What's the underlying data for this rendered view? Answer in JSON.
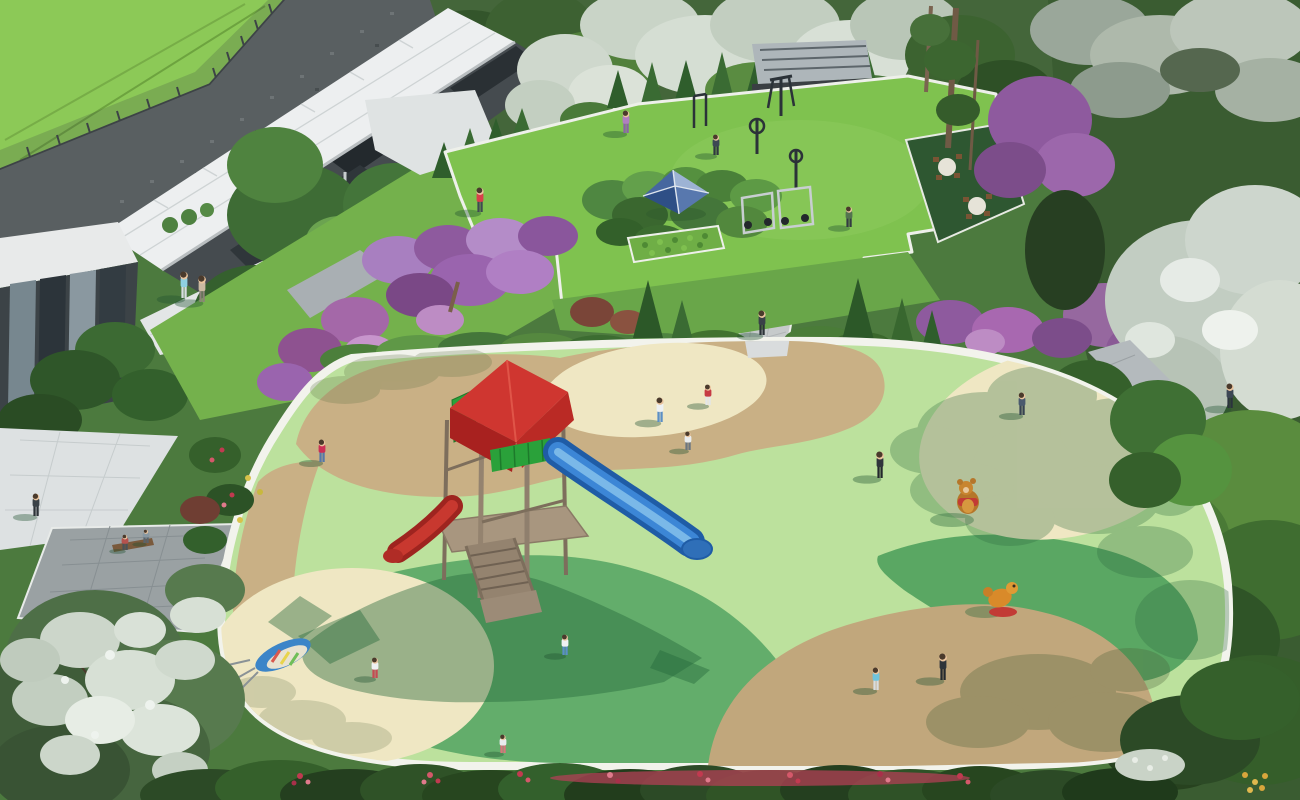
{
  "scene": {
    "description": "Aerial architectural rendering of a community park: children's playground with rubber surface, outdoor fitness lawn, clubhouse with white canopy roofs, paved plazas and dense flowering vegetation",
    "style": "3d-render-birdseye"
  },
  "palette": {
    "rim": "#f2f3ec",
    "pg_light": "#bce19d",
    "pg_mid": "#63ad6b",
    "pg_mid2": "#5aa763",
    "pg_tan": "#c9b085",
    "pg_tan2": "#c1a77c",
    "pg_cream": "#efe7c3",
    "lawn": "#7fc24f",
    "slide_blue": "#3c86d6",
    "slide_blue_dark": "#1f5ca6",
    "slide_blue_light": "#7ab8e8",
    "slide_red": "#c8382f",
    "slide_red_dark": "#9e241f",
    "roof_red": "#cf3630",
    "roof_red_dark": "#a8211f",
    "panel_green": "#2aa13a",
    "wood": "#94836f",
    "wood_dark": "#6f6152",
    "tent_light": "#9db3d4",
    "tent_mid": "#5878ae",
    "tent_dark": "#2e4f86",
    "tent_mid2": "#46679f",
    "bear_brown": "#b5762a",
    "rider_orange": "#d98a2a",
    "rider_base_red": "#c23b35",
    "plaza": "#e3e6e6",
    "paver": "#9aa1a3",
    "stone": "#595f61",
    "wall": "#454b4f",
    "canopy": "#edeff0",
    "slope_green": "#8cc957",
    "forest": "#3a5c31",
    "purple": "#8e5a9e",
    "purple_light": "#a87fc0",
    "flower_red": "#c13a50",
    "shadow_green": "#23663a"
  },
  "playground": {
    "surface_zones": [
      "light-green-rubber",
      "medium-green-rubber",
      "sand-tan",
      "cream-circles"
    ],
    "equipment": [
      "wooden-tower-with-red-roof",
      "blue-slide",
      "red-slide",
      "wooden-stairs"
    ],
    "spring_riders": [
      "teddy-bear-rider",
      "orange-animal-rider"
    ],
    "toys": [
      "rainbow-kite"
    ]
  },
  "fitness_area": {
    "features": [
      "outdoor-gym-machines",
      "blue-canopy-tent",
      "hedge-garden",
      "round-table-seating",
      "conifer-row",
      "glass-pavilion"
    ]
  },
  "buildings": [
    "clubhouse-with-white-tiled-canopies",
    "glass-wall-annex",
    "stone-retaining-wall",
    "fenced-green-slope"
  ],
  "people": [
    {
      "x": 184,
      "y": 298,
      "h": 26,
      "shirt": "#8fd0e2",
      "pants": "#d8dde0"
    },
    {
      "x": 202,
      "y": 302,
      "h": 26,
      "shirt": "#cbb9a2",
      "pants": "#8b8378"
    },
    {
      "x": 480,
      "y": 212,
      "h": 24,
      "shirt": "#d8404a",
      "pants": "#3f4a52"
    },
    {
      "x": 626,
      "y": 133,
      "h": 22,
      "shirt": "#b07fc0",
      "pants": "#8a62a8"
    },
    {
      "x": 716,
      "y": 155,
      "h": 20,
      "shirt": "#3d4854",
      "pants": "#2f3840"
    },
    {
      "x": 849,
      "y": 227,
      "h": 20,
      "shirt": "#53734f",
      "pants": "#333b42"
    },
    {
      "x": 762,
      "y": 335,
      "h": 24,
      "shirt": "#3a4148",
      "pants": "#2c3338"
    },
    {
      "x": 660,
      "y": 422,
      "h": 24,
      "shirt": "#eef1f2",
      "pants": "#5b8fc6"
    },
    {
      "x": 708,
      "y": 405,
      "h": 20,
      "shirt": "#c63b44",
      "pants": "#e3e6e8"
    },
    {
      "x": 688,
      "y": 450,
      "h": 18,
      "shirt": "#e9ecee",
      "pants": "#6b7680"
    },
    {
      "x": 880,
      "y": 478,
      "h": 26,
      "shirt": "#2f353b",
      "pants": "#23282d"
    },
    {
      "x": 322,
      "y": 462,
      "h": 22,
      "shirt": "#cc2f55",
      "pants": "#5577a8"
    },
    {
      "x": 1022,
      "y": 415,
      "h": 22,
      "shirt": "#4a5a6e",
      "pants": "#374351"
    },
    {
      "x": 1230,
      "y": 408,
      "h": 24,
      "shirt": "#3c4654",
      "pants": "#2b333d"
    },
    {
      "x": 943,
      "y": 680,
      "h": 26,
      "shirt": "#2e343a",
      "pants": "#24292e"
    },
    {
      "x": 876,
      "y": 690,
      "h": 22,
      "shirt": "#6fc4dd",
      "pants": "#d8dde0"
    },
    {
      "x": 565,
      "y": 655,
      "h": 20,
      "shirt": "#eef1f2",
      "pants": "#5b8fc6"
    },
    {
      "x": 503,
      "y": 753,
      "h": 18,
      "shirt": "#e9ecee",
      "pants": "#d8747c"
    },
    {
      "x": 375,
      "y": 678,
      "h": 20,
      "shirt": "#eef1f2",
      "pants": "#c64a52"
    },
    {
      "x": 125,
      "y": 550,
      "h": 15,
      "shirt": "#b5524e",
      "pants": "#4a5258"
    },
    {
      "x": 146,
      "y": 543,
      "h": 13,
      "shirt": "#8898a2",
      "pants": "#5a646c"
    },
    {
      "x": 36,
      "y": 516,
      "h": 22,
      "shirt": "#3a4248",
      "pants": "#2d3338"
    }
  ]
}
